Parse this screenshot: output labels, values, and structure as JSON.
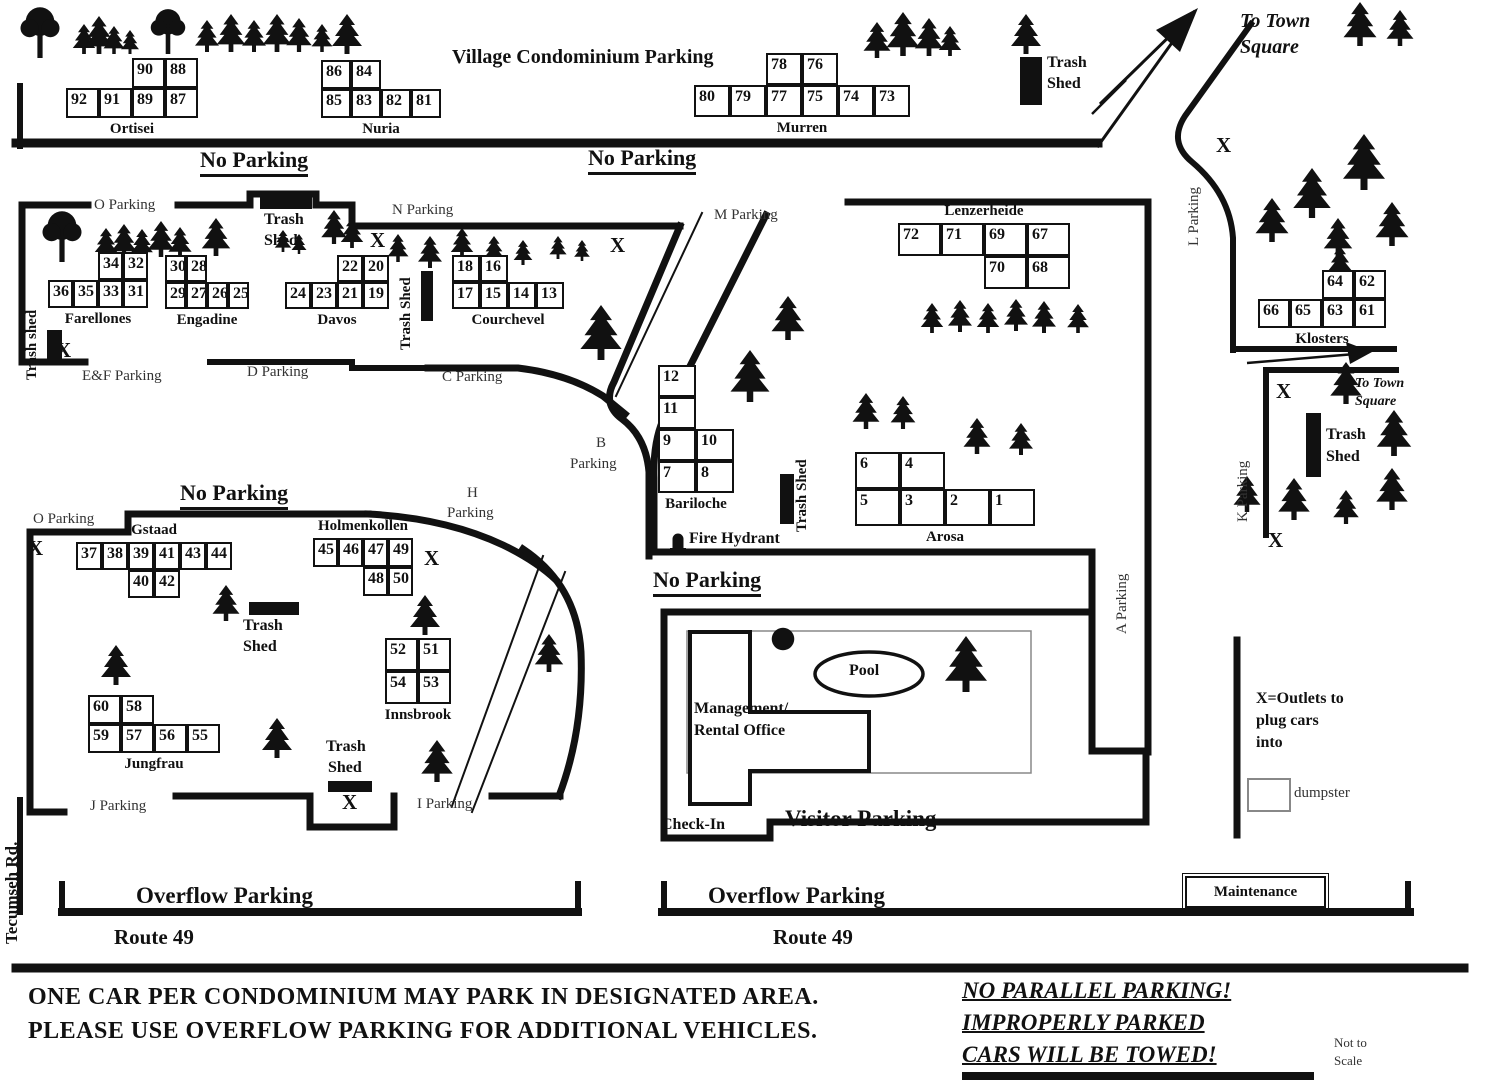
{
  "title": "Village Condominium Parking",
  "ink": "#111111",
  "legend": {
    "maintenance": "Maintenance",
    "dumpster": "dumpster",
    "outlets": "X=Outlets to plug cars into"
  },
  "buildings": [
    {
      "name": "Ortisei",
      "x": 66,
      "y": 58,
      "cw": 33,
      "ch": 30,
      "pos": "b",
      "cells": [
        [
          90,
          0,
          2
        ],
        [
          88,
          0,
          3
        ],
        [
          92,
          1,
          0
        ],
        [
          91,
          1,
          1
        ],
        [
          89,
          1,
          2
        ],
        [
          87,
          1,
          3
        ]
      ]
    },
    {
      "name": "Nuria",
      "x": 321,
      "y": 60,
      "cw": 30,
      "ch": 29,
      "pos": "b",
      "cells": [
        [
          86,
          0,
          0
        ],
        [
          84,
          0,
          1
        ],
        [
          85,
          1,
          0
        ],
        [
          83,
          1,
          1
        ],
        [
          82,
          1,
          2
        ],
        [
          81,
          1,
          3
        ]
      ]
    },
    {
      "name": "Murren",
      "x": 694,
      "y": 53,
      "cw": 36,
      "ch": 32,
      "pos": "b",
      "cells": [
        [
          78,
          0,
          2
        ],
        [
          76,
          0,
          3
        ],
        [
          80,
          1,
          0
        ],
        [
          79,
          1,
          1
        ],
        [
          77,
          1,
          2
        ],
        [
          75,
          1,
          3
        ],
        [
          74,
          1,
          4
        ],
        [
          73,
          1,
          5
        ]
      ]
    },
    {
      "name": "Farellones",
      "x": 48,
      "y": 252,
      "cw": 25,
      "ch": 28,
      "pos": "b",
      "cells": [
        [
          34,
          0,
          2
        ],
        [
          32,
          0,
          3
        ],
        [
          36,
          1,
          0
        ],
        [
          35,
          1,
          1
        ],
        [
          33,
          1,
          2
        ],
        [
          31,
          1,
          3
        ]
      ]
    },
    {
      "name": "Engadine",
      "x": 165,
      "y": 255,
      "cw": 21,
      "ch": 27,
      "pos": "b",
      "cells": [
        [
          30,
          0,
          0
        ],
        [
          28,
          0,
          1
        ],
        [
          29,
          1,
          0
        ],
        [
          27,
          1,
          1
        ],
        [
          26,
          1,
          2
        ],
        [
          25,
          1,
          3
        ]
      ]
    },
    {
      "name": "Davos",
      "x": 285,
      "y": 255,
      "cw": 26,
      "ch": 27,
      "pos": "b",
      "cells": [
        [
          22,
          0,
          2
        ],
        [
          20,
          0,
          3
        ],
        [
          24,
          1,
          0
        ],
        [
          23,
          1,
          1
        ],
        [
          21,
          1,
          2
        ],
        [
          19,
          1,
          3
        ]
      ]
    },
    {
      "name": "Courchevel",
      "x": 452,
      "y": 255,
      "cw": 28,
      "ch": 27,
      "pos": "b",
      "cells": [
        [
          18,
          0,
          0
        ],
        [
          16,
          0,
          1
        ],
        [
          17,
          1,
          0
        ],
        [
          15,
          1,
          1
        ],
        [
          14,
          1,
          2
        ],
        [
          13,
          1,
          3
        ]
      ]
    },
    {
      "name": "Lenzerheide",
      "x": 898,
      "y": 223,
      "cw": 43,
      "ch": 33,
      "pos": "t",
      "cells": [
        [
          72,
          0,
          0
        ],
        [
          71,
          0,
          1
        ],
        [
          69,
          0,
          2
        ],
        [
          67,
          0,
          3
        ],
        [
          70,
          1,
          2
        ],
        [
          68,
          1,
          3
        ]
      ]
    },
    {
      "name": "Klosters",
      "x": 1258,
      "y": 270,
      "cw": 32,
      "ch": 29,
      "pos": "b",
      "cells": [
        [
          64,
          0,
          2
        ],
        [
          62,
          0,
          3
        ],
        [
          66,
          1,
          0
        ],
        [
          65,
          1,
          1
        ],
        [
          63,
          1,
          2
        ],
        [
          61,
          1,
          3
        ]
      ]
    },
    {
      "name": "Bariloche",
      "x": 658,
      "y": 365,
      "cw": 38,
      "ch": 32,
      "pos": "b",
      "cells": [
        [
          12,
          0,
          0
        ],
        [
          11,
          1,
          0
        ],
        [
          9,
          2,
          0
        ],
        [
          10,
          2,
          1
        ],
        [
          7,
          3,
          0
        ],
        [
          8,
          3,
          1
        ]
      ]
    },
    {
      "name": "Arosa",
      "x": 855,
      "y": 452,
      "cw": 45,
      "ch": 37,
      "pos": "b",
      "cells": [
        [
          6,
          0,
          0
        ],
        [
          4,
          0,
          1
        ],
        [
          5,
          1,
          0
        ],
        [
          3,
          1,
          1
        ],
        [
          2,
          1,
          2
        ],
        [
          1,
          1,
          3
        ]
      ]
    },
    {
      "name": "Gstaad",
      "x": 76,
      "y": 542,
      "cw": 26,
      "ch": 28,
      "pos": "t",
      "cells": [
        [
          37,
          0,
          0
        ],
        [
          38,
          0,
          1
        ],
        [
          39,
          0,
          2
        ],
        [
          41,
          0,
          3
        ],
        [
          43,
          0,
          4
        ],
        [
          44,
          0,
          5
        ],
        [
          40,
          1,
          2
        ],
        [
          42,
          1,
          3
        ]
      ]
    },
    {
      "name": "Holmenkollen",
      "x": 313,
      "y": 538,
      "cw": 25,
      "ch": 29,
      "pos": "t",
      "cells": [
        [
          45,
          0,
          0
        ],
        [
          46,
          0,
          1
        ],
        [
          47,
          0,
          2
        ],
        [
          49,
          0,
          3
        ],
        [
          48,
          1,
          2
        ],
        [
          50,
          1,
          3
        ]
      ]
    },
    {
      "name": "Innsbrook",
      "x": 385,
      "y": 638,
      "cw": 33,
      "ch": 33,
      "pos": "b",
      "cells": [
        [
          52,
          0,
          0
        ],
        [
          51,
          0,
          1
        ],
        [
          54,
          1,
          0
        ],
        [
          53,
          1,
          1
        ]
      ]
    },
    {
      "name": "Jungfrau",
      "x": 88,
      "y": 695,
      "cw": 33,
      "ch": 29,
      "pos": "b",
      "cells": [
        [
          60,
          0,
          0
        ],
        [
          58,
          0,
          1
        ],
        [
          59,
          1,
          0
        ],
        [
          57,
          1,
          1
        ],
        [
          56,
          1,
          2
        ],
        [
          55,
          1,
          3
        ]
      ]
    }
  ],
  "labels": [
    {
      "t": "Village Condominium Parking",
      "x": 452,
      "y": 46,
      "c": "title"
    },
    {
      "t": "No Parking",
      "x": 200,
      "y": 147,
      "c": "np"
    },
    {
      "t": "No Parking",
      "x": 588,
      "y": 145,
      "c": "np"
    },
    {
      "t": "No Parking",
      "x": 180,
      "y": 480,
      "c": "np"
    },
    {
      "t": "No Parking",
      "x": 653,
      "y": 567,
      "c": "np"
    },
    {
      "t": "O Parking",
      "x": 94,
      "y": 197,
      "c": "area"
    },
    {
      "t": "N Parking",
      "x": 392,
      "y": 202,
      "c": "area"
    },
    {
      "t": "M Parking",
      "x": 714,
      "y": 207,
      "c": "area"
    },
    {
      "t": "E&F Parking",
      "x": 82,
      "y": 368,
      "c": "area"
    },
    {
      "t": "D Parking",
      "x": 247,
      "y": 364,
      "c": "area"
    },
    {
      "t": "C Parking",
      "x": 442,
      "y": 369,
      "c": "area"
    },
    {
      "t": "B",
      "x": 596,
      "y": 435,
      "c": "area"
    },
    {
      "t": "Parking",
      "x": 570,
      "y": 456,
      "c": "area"
    },
    {
      "t": "H",
      "x": 467,
      "y": 485,
      "c": "area"
    },
    {
      "t": "Parking",
      "x": 447,
      "y": 505,
      "c": "area"
    },
    {
      "t": "O Parking",
      "x": 33,
      "y": 511,
      "c": "area"
    },
    {
      "t": "J Parking",
      "x": 90,
      "y": 798,
      "c": "area"
    },
    {
      "t": "I Parking",
      "x": 417,
      "y": 796,
      "c": "area"
    },
    {
      "t": "To Town",
      "x": 1240,
      "y": 10,
      "c": "tts"
    },
    {
      "t": "Square",
      "x": 1240,
      "y": 36,
      "c": "tts"
    },
    {
      "t": "To Town",
      "x": 1355,
      "y": 376,
      "c": "tts2"
    },
    {
      "t": "Square",
      "x": 1355,
      "y": 394,
      "c": "tts2"
    },
    {
      "t": "Fire Hydrant",
      "x": 689,
      "y": 530,
      "c": "lbl"
    },
    {
      "t": "Pool",
      "x": 849,
      "y": 662,
      "c": "lbl"
    },
    {
      "t": "Management/",
      "x": 694,
      "y": 700,
      "c": "lbl"
    },
    {
      "t": "Rental Office",
      "x": 694,
      "y": 722,
      "c": "lbl"
    },
    {
      "t": "Check-In",
      "x": 661,
      "y": 816,
      "c": "lbl"
    },
    {
      "t": "Visitor Parking",
      "x": 785,
      "y": 806,
      "c": "big"
    },
    {
      "t": "Overflow Parking",
      "x": 136,
      "y": 883,
      "c": "big"
    },
    {
      "t": "Overflow Parking",
      "x": 708,
      "y": 883,
      "c": "big"
    },
    {
      "t": "Route 49",
      "x": 114,
      "y": 925,
      "c": "big2"
    },
    {
      "t": "Route 49",
      "x": 773,
      "y": 925,
      "c": "big2"
    },
    {
      "t": "X=Outlets to",
      "x": 1256,
      "y": 690,
      "c": "lbl"
    },
    {
      "t": "plug cars",
      "x": 1256,
      "y": 712,
      "c": "lbl"
    },
    {
      "t": "into",
      "x": 1256,
      "y": 734,
      "c": "lbl"
    },
    {
      "t": "Not to",
      "x": 1334,
      "y": 1035,
      "c": "small"
    },
    {
      "t": "Scale",
      "x": 1334,
      "y": 1053,
      "c": "small"
    },
    {
      "t": "ONE CAR PER CONDOMINIUM MAY PARK IN DESIGNATED AREA.",
      "x": 28,
      "y": 984,
      "c": "note"
    },
    {
      "t": "PLEASE USE OVERFLOW PARKING FOR ADDITIONAL VEHICLES.",
      "x": 28,
      "y": 1018,
      "c": "note"
    },
    {
      "t": "NO PARALLEL PARKING!",
      "x": 962,
      "y": 978,
      "c": "warn"
    },
    {
      "t": "IMPROPERLY PARKED",
      "x": 962,
      "y": 1010,
      "c": "warn"
    },
    {
      "t": "CARS WILL BE TOWED!",
      "x": 962,
      "y": 1042,
      "c": "warn"
    },
    {
      "t": "Trash",
      "x": 1047,
      "y": 54,
      "c": "lbl"
    },
    {
      "t": "Shed",
      "x": 1047,
      "y": 75,
      "c": "lbl"
    },
    {
      "t": "Trash",
      "x": 264,
      "y": 211,
      "c": "lbl"
    },
    {
      "t": "Shed",
      "x": 264,
      "y": 232,
      "c": "lbl"
    },
    {
      "t": "Trash",
      "x": 1326,
      "y": 426,
      "c": "lbl"
    },
    {
      "t": "Shed",
      "x": 1326,
      "y": 448,
      "c": "lbl"
    },
    {
      "t": "Trash",
      "x": 243,
      "y": 617,
      "c": "lbl"
    },
    {
      "t": "Shed",
      "x": 243,
      "y": 638,
      "c": "lbl"
    },
    {
      "t": "Trash",
      "x": 326,
      "y": 738,
      "c": "lbl"
    },
    {
      "t": "Shed",
      "x": 328,
      "y": 759,
      "c": "lbl"
    }
  ],
  "vlabels": [
    {
      "t": "L Parking",
      "x": 1186,
      "y": 246,
      "c": "v"
    },
    {
      "t": "K Parking",
      "x": 1235,
      "y": 522,
      "c": "v"
    },
    {
      "t": "A Parking",
      "x": 1114,
      "y": 634,
      "c": "v"
    },
    {
      "t": "Trash shed",
      "x": 24,
      "y": 380,
      "c": "vb"
    },
    {
      "t": "Trash Shed",
      "x": 398,
      "y": 350,
      "c": "vb"
    },
    {
      "t": "Trash Shed",
      "x": 794,
      "y": 532,
      "c": "vb"
    },
    {
      "t": "Tecumseh Rd.",
      "x": 2,
      "y": 944,
      "c": "vtr"
    }
  ],
  "x_marks": [
    [
      370,
      228
    ],
    [
      610,
      233
    ],
    [
      56,
      338
    ],
    [
      1216,
      133
    ],
    [
      1276,
      379
    ],
    [
      1268,
      528
    ],
    [
      28,
      536
    ],
    [
      424,
      546
    ],
    [
      342,
      790
    ]
  ],
  "trash_shed_rects": [
    [
      1020,
      57,
      22,
      48
    ],
    [
      260,
      196,
      52,
      13
    ],
    [
      47,
      330,
      15,
      33
    ],
    [
      421,
      271,
      12,
      50
    ],
    [
      780,
      474,
      14,
      50
    ],
    [
      1306,
      413,
      15,
      64
    ],
    [
      249,
      602,
      50,
      13
    ],
    [
      328,
      781,
      44,
      11
    ]
  ],
  "trees": [
    [
      "r",
      40,
      6,
      52
    ],
    [
      "p",
      84,
      24,
      30
    ],
    [
      "p",
      99,
      16,
      38
    ],
    [
      "p",
      114,
      26,
      28
    ],
    [
      "p",
      130,
      30,
      24
    ],
    [
      "r",
      168,
      8,
      46
    ],
    [
      "p",
      207,
      20,
      32
    ],
    [
      "p",
      231,
      14,
      38
    ],
    [
      "p",
      254,
      20,
      32
    ],
    [
      "p",
      277,
      14,
      38
    ],
    [
      "p",
      299,
      18,
      34
    ],
    [
      "p",
      322,
      24,
      28
    ],
    [
      "p",
      347,
      14,
      40
    ],
    [
      "p",
      877,
      22,
      36
    ],
    [
      "p",
      903,
      12,
      44
    ],
    [
      "p",
      929,
      18,
      38
    ],
    [
      "p",
      950,
      26,
      30
    ],
    [
      "p",
      1026,
      14,
      40
    ],
    [
      "p",
      1360,
      2,
      44
    ],
    [
      "p",
      1400,
      10,
      36
    ],
    [
      "p",
      1272,
      198,
      44
    ],
    [
      "p",
      1312,
      168,
      50
    ],
    [
      "p",
      1338,
      218,
      38
    ],
    [
      "p",
      1364,
      134,
      56
    ],
    [
      "p",
      1392,
      202,
      44
    ],
    [
      "p",
      1340,
      246,
      30
    ],
    [
      "r",
      62,
      210,
      52
    ],
    [
      "p",
      106,
      228,
      30
    ],
    [
      "p",
      124,
      224,
      34
    ],
    [
      "p",
      142,
      229,
      29
    ],
    [
      "p",
      161,
      221,
      36
    ],
    [
      "p",
      180,
      227,
      31
    ],
    [
      "p",
      216,
      218,
      38
    ],
    [
      "p",
      283,
      230,
      22
    ],
    [
      "p",
      299,
      234,
      20
    ],
    [
      "p",
      334,
      210,
      34
    ],
    [
      "p",
      352,
      218,
      30
    ],
    [
      "p",
      398,
      234,
      28
    ],
    [
      "p",
      430,
      236,
      32
    ],
    [
      "p",
      462,
      228,
      30
    ],
    [
      "p",
      494,
      236,
      28
    ],
    [
      "p",
      523,
      240,
      25
    ],
    [
      "p",
      558,
      236,
      23
    ],
    [
      "p",
      582,
      240,
      21
    ],
    [
      "p",
      601,
      305,
      55
    ],
    [
      "p",
      750,
      350,
      52
    ],
    [
      "p",
      788,
      296,
      44
    ],
    [
      "p",
      932,
      303,
      30
    ],
    [
      "p",
      960,
      300,
      32
    ],
    [
      "p",
      988,
      303,
      30
    ],
    [
      "p",
      1016,
      299,
      32
    ],
    [
      "p",
      1044,
      301,
      32
    ],
    [
      "p",
      1078,
      304,
      29
    ],
    [
      "p",
      866,
      393,
      36
    ],
    [
      "p",
      903,
      396,
      33
    ],
    [
      "p",
      977,
      418,
      36
    ],
    [
      "p",
      1021,
      423,
      32
    ],
    [
      "p",
      226,
      585,
      36
    ],
    [
      "p",
      425,
      595,
      40
    ],
    [
      "p",
      116,
      645,
      40
    ],
    [
      "p",
      277,
      718,
      40
    ],
    [
      "p",
      549,
      634,
      38
    ],
    [
      "p",
      437,
      740,
      42
    ],
    [
      "p",
      1346,
      362,
      42
    ],
    [
      "p",
      1394,
      410,
      46
    ],
    [
      "p",
      1294,
      478,
      42
    ],
    [
      "p",
      1247,
      476,
      36
    ],
    [
      "p",
      1392,
      468,
      42
    ],
    [
      "p",
      1346,
      490,
      34
    ],
    [
      "p",
      966,
      636,
      56
    ],
    [
      "b",
      783,
      626,
      26
    ]
  ]
}
